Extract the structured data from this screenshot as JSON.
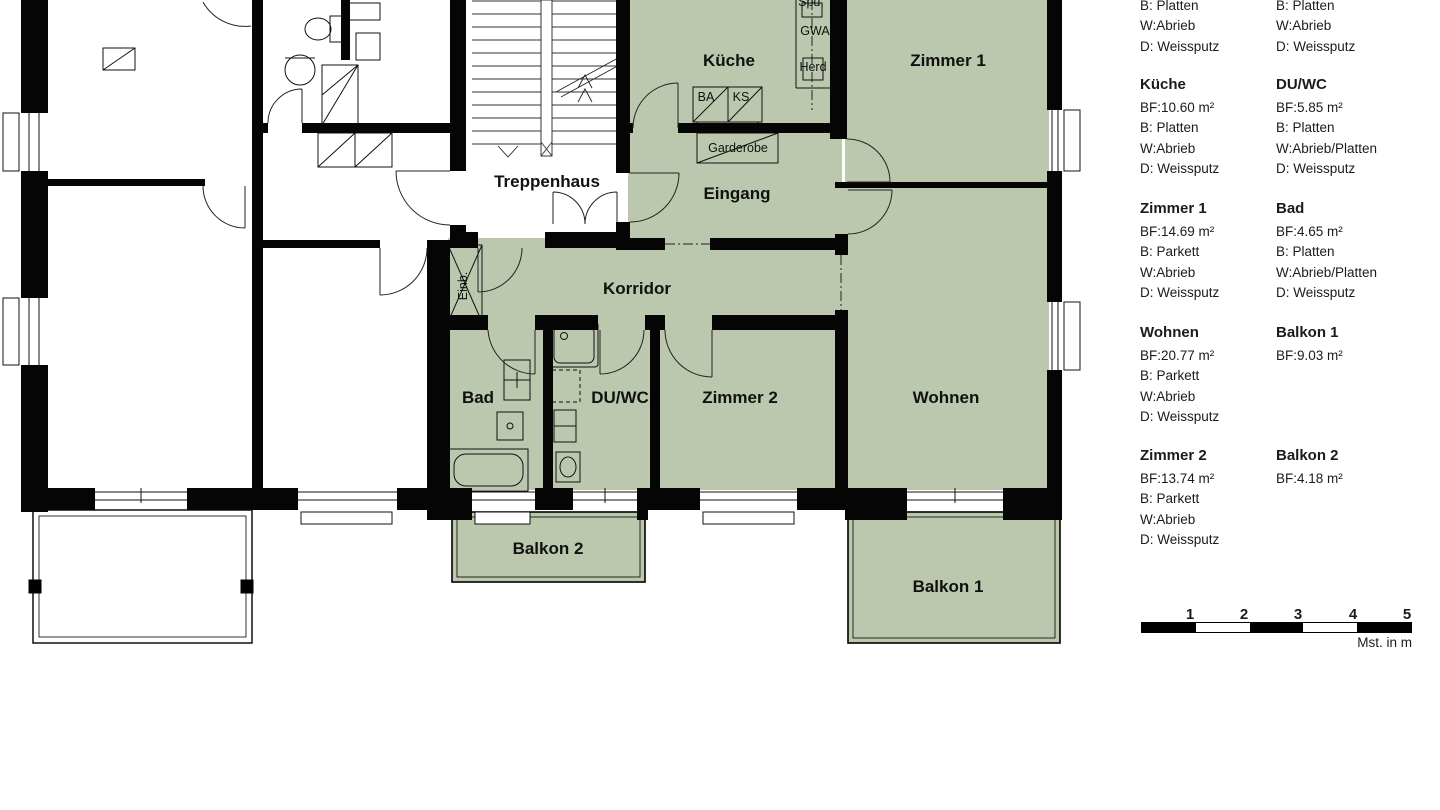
{
  "plan": {
    "rooms": {
      "kueche": "Küche",
      "zimmer1": "Zimmer 1",
      "eingang": "Eingang",
      "treppenhaus": "Treppenhaus",
      "korridor": "Korridor",
      "bad": "Bad",
      "duwc": "DU/WC",
      "zimmer2": "Zimmer 2",
      "wohnen": "Wohnen",
      "balkon1": "Balkon 1",
      "balkon2": "Balkon 2"
    },
    "annotations": {
      "garderobe": "Garderobe",
      "einbau": "Einb.",
      "ba": "BA",
      "ks": "KS",
      "spuele": "Spü.",
      "gwa": "GWA",
      "herd": "Herd"
    }
  },
  "legend": {
    "entries": [
      {
        "title": "",
        "lines": [
          "B: Platten",
          "W:Abrieb",
          "D: Weissputz"
        ]
      },
      {
        "title": "",
        "lines": [
          "B: Platten",
          "W:Abrieb",
          "D: Weissputz"
        ]
      },
      {
        "title": "Küche",
        "lines": [
          "BF:10.60 m²",
          "B: Platten",
          "W:Abrieb",
          "D: Weissputz"
        ]
      },
      {
        "title": "DU/WC",
        "lines": [
          "BF:5.85 m²",
          "B: Platten",
          "W:Abrieb/Platten",
          "D: Weissputz"
        ]
      },
      {
        "title": "Zimmer 1",
        "lines": [
          "BF:14.69 m²",
          "B: Parkett",
          "W:Abrieb",
          "D: Weissputz"
        ]
      },
      {
        "title": "Bad",
        "lines": [
          "BF:4.65 m²",
          "B: Platten",
          "W:Abrieb/Platten",
          "D: Weissputz"
        ]
      },
      {
        "title": "Wohnen",
        "lines": [
          "BF:20.77 m²",
          "B: Parkett",
          "W:Abrieb",
          "D: Weissputz"
        ]
      },
      {
        "title": "Balkon 1",
        "lines": [
          "BF:9.03 m²"
        ]
      },
      {
        "title": "Zimmer 2",
        "lines": [
          "BF:13.74 m²",
          "B: Parkett",
          "W:Abrieb",
          "D: Weissputz"
        ]
      },
      {
        "title": "Balkon 2",
        "lines": [
          "BF:4.18 m²"
        ]
      }
    ]
  },
  "scale": {
    "ticks": [
      "1",
      "2",
      "3",
      "4",
      "5"
    ],
    "label": "Mst. in m"
  },
  "colors": {
    "room_fill": "#bcc8ad",
    "wall": "#050505",
    "line": "#161616"
  }
}
